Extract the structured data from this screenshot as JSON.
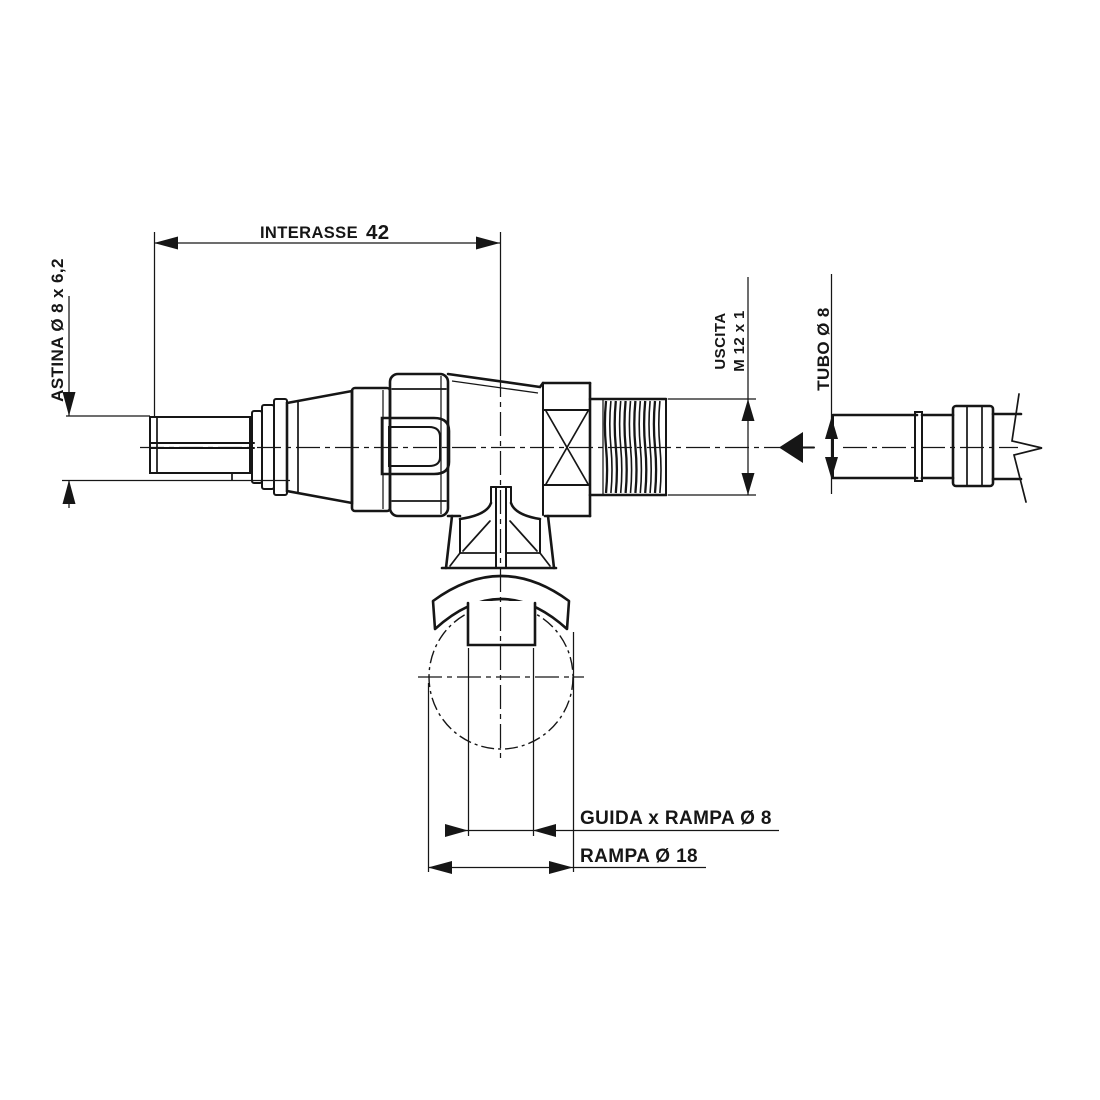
{
  "drawing": {
    "type": "technical-drawing",
    "labels": {
      "interasse": "INTERASSE",
      "interasse_value": "42",
      "astina": "ASTINA Ø 8 x 6,2",
      "uscita": "USCITA",
      "uscita_thread": "M 12 x 1",
      "tubo": "TUBO Ø 8",
      "guida": "GUIDA x RAMPA Ø 8",
      "rampa": "RAMPA Ø 18"
    },
    "colors": {
      "ink": "#161616",
      "background": "#ffffff"
    }
  }
}
